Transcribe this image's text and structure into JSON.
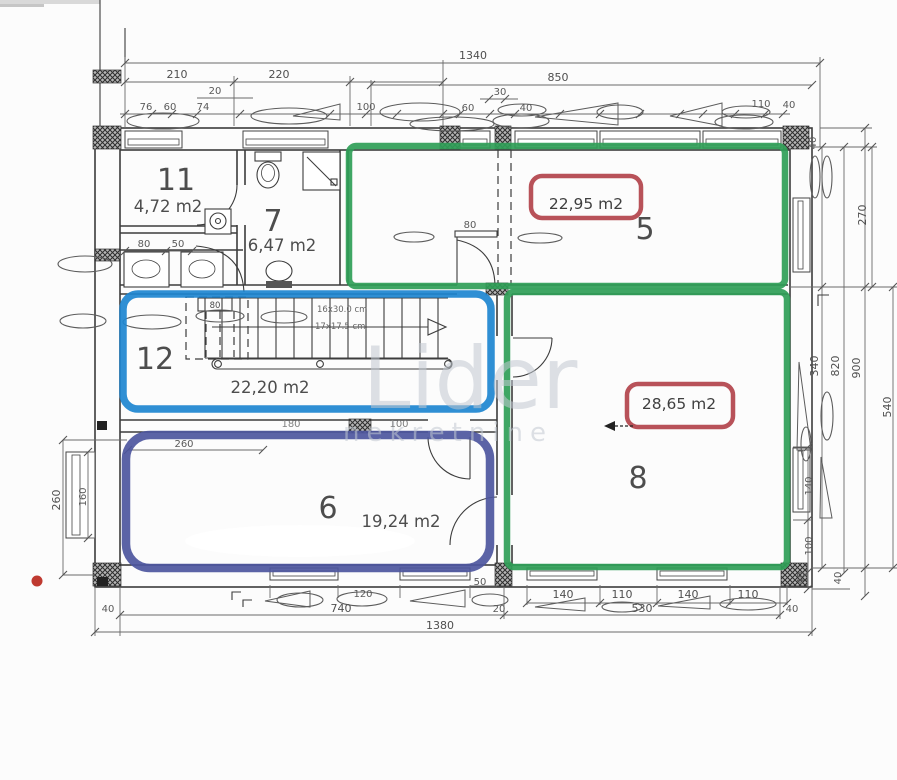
{
  "plan": {
    "rooms": {
      "r11": {
        "number": "11",
        "area": "4,72 m2"
      },
      "r7": {
        "number": "7",
        "area": "6,47 m2"
      },
      "r5": {
        "number": "5",
        "area_badge": "22,95 m2"
      },
      "r12": {
        "number": "12",
        "area": "22,20 m2"
      },
      "r8": {
        "number": "8",
        "area_badge": "28,65 m2"
      },
      "r6": {
        "number": "6",
        "area": "19,24 m2"
      }
    },
    "stairs": {
      "note_line1": "16x30.0 cm",
      "note_line2": "17x17.5 cm",
      "closet_width": "80"
    },
    "watermark": {
      "line1": "Lider",
      "line2": "nekretnine"
    },
    "dims": {
      "top": {
        "overall": "1340",
        "seg1": "210",
        "seg2": "220",
        "seg3": "850",
        "d20": "20",
        "d30": "30",
        "s76": "76",
        "s60": "60",
        "s74": "74",
        "s100": "100",
        "s60b": "60",
        "s40b": "40",
        "s110": "110",
        "s40c": "40"
      },
      "right": {
        "w40": "40",
        "d270": "270",
        "d340": "340",
        "d820": "820",
        "d900": "900",
        "d540": "540",
        "d140": "140",
        "d100": "100",
        "d40a": "40",
        "d40b": "40"
      },
      "bottom": {
        "d50": "50",
        "d120": "120",
        "d740": "740",
        "d40l": "40",
        "overall": "1380",
        "d140a": "140",
        "d110a": "110",
        "d140b": "140",
        "d110b": "110",
        "d530": "530",
        "d40r": "40",
        "d20": "20"
      },
      "left": {
        "d260": "260",
        "d160": "160",
        "d80": "80",
        "d50": "50",
        "d180": "180",
        "d100": "100",
        "d260b": "260"
      },
      "mid": {
        "door80": "80"
      }
    }
  },
  "colors": {
    "green": "#2f9e57",
    "blue": "#1d86d0",
    "navy": "#4d569e",
    "red": "#b2434b",
    "reddot": "#bf3a30",
    "line": "#3c3c3c",
    "dim": "#6a6a6a",
    "text": "#4a4a4a",
    "paper": "#fcfcfc",
    "watermark": "#c2c9d2"
  }
}
